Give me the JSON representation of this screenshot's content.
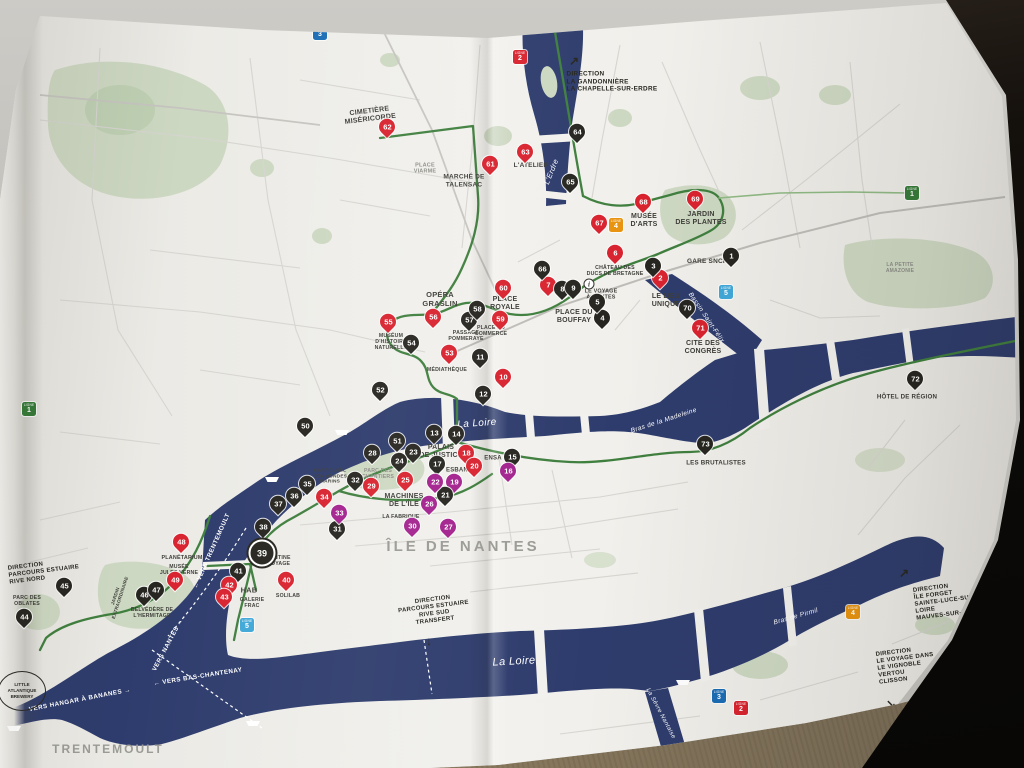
{
  "map": {
    "badge_word": "LIGNE",
    "colors": {
      "river": "#2e3c6d",
      "park": "#cdd8c2",
      "route_green": "#3f7f3e",
      "marker_red": "#d8232f",
      "marker_black": "#26251f",
      "marker_magenta": "#a3228e",
      "line1_green": "#357a38",
      "line2_red": "#d8232f",
      "line3_blue": "#1b6db5",
      "line4_orange": "#e8930f",
      "line5_blue": "#41a8d8",
      "paper": "#f0efeb"
    },
    "markers": [
      {
        "n": 1,
        "c": "k",
        "x": 731,
        "y": 257
      },
      {
        "n": 2,
        "c": "r",
        "x": 660,
        "y": 279
      },
      {
        "n": 3,
        "c": "k",
        "x": 653,
        "y": 267
      },
      {
        "n": 4,
        "c": "k",
        "x": 602,
        "y": 319
      },
      {
        "n": 5,
        "c": "k",
        "x": 597,
        "y": 303
      },
      {
        "n": 6,
        "c": "r",
        "x": 615,
        "y": 254
      },
      {
        "n": 7,
        "c": "r",
        "x": 548,
        "y": 286
      },
      {
        "n": 8,
        "c": "k",
        "x": 562,
        "y": 290
      },
      {
        "n": 9,
        "c": "k",
        "x": 573,
        "y": 289
      },
      {
        "n": 10,
        "c": "r",
        "x": 503,
        "y": 378
      },
      {
        "n": 11,
        "c": "k",
        "x": 480,
        "y": 358
      },
      {
        "n": 12,
        "c": "k",
        "x": 483,
        "y": 395
      },
      {
        "n": 13,
        "c": "k",
        "x": 434,
        "y": 434
      },
      {
        "n": 14,
        "c": "k",
        "x": 456,
        "y": 435
      },
      {
        "n": 15,
        "c": "k",
        "x": 512,
        "y": 458
      },
      {
        "n": 16,
        "c": "m",
        "x": 508,
        "y": 472
      },
      {
        "n": 17,
        "c": "k",
        "x": 437,
        "y": 465
      },
      {
        "n": 18,
        "c": "r",
        "x": 466,
        "y": 454
      },
      {
        "n": 19,
        "c": "m",
        "x": 454,
        "y": 483
      },
      {
        "n": 20,
        "c": "r",
        "x": 474,
        "y": 467
      },
      {
        "n": 21,
        "c": "k",
        "x": 445,
        "y": 496
      },
      {
        "n": 22,
        "c": "m",
        "x": 435,
        "y": 483
      },
      {
        "n": 23,
        "c": "k",
        "x": 413,
        "y": 453
      },
      {
        "n": 24,
        "c": "k",
        "x": 399,
        "y": 462
      },
      {
        "n": 25,
        "c": "r",
        "x": 405,
        "y": 481
      },
      {
        "n": 26,
        "c": "m",
        "x": 429,
        "y": 505
      },
      {
        "n": 27,
        "c": "m",
        "x": 448,
        "y": 528
      },
      {
        "n": 28,
        "c": "k",
        "x": 372,
        "y": 454
      },
      {
        "n": 29,
        "c": "r",
        "x": 371,
        "y": 487
      },
      {
        "n": 30,
        "c": "m",
        "x": 412,
        "y": 527
      },
      {
        "n": 31,
        "c": "k",
        "x": 337,
        "y": 530
      },
      {
        "n": 32,
        "c": "k",
        "x": 355,
        "y": 481
      },
      {
        "n": 33,
        "c": "m",
        "x": 339,
        "y": 514
      },
      {
        "n": 34,
        "c": "r",
        "x": 324,
        "y": 498
      },
      {
        "n": 35,
        "c": "k",
        "x": 307,
        "y": 485
      },
      {
        "n": 36,
        "c": "k",
        "x": 294,
        "y": 497
      },
      {
        "n": 37,
        "c": "k",
        "x": 278,
        "y": 505
      },
      {
        "n": 38,
        "c": "k",
        "x": 263,
        "y": 528
      },
      {
        "n": 39,
        "c": "k",
        "x": 262,
        "y": 553
      },
      {
        "n": 40,
        "c": "r",
        "x": 286,
        "y": 581
      },
      {
        "n": 41,
        "c": "k",
        "x": 238,
        "y": 572
      },
      {
        "n": 42,
        "c": "r",
        "x": 229,
        "y": 586
      },
      {
        "n": 43,
        "c": "r",
        "x": 224,
        "y": 598
      },
      {
        "n": 44,
        "c": "k",
        "x": 24,
        "y": 618
      },
      {
        "n": 45,
        "c": "k",
        "x": 64,
        "y": 587
      },
      {
        "n": 46,
        "c": "k",
        "x": 144,
        "y": 596
      },
      {
        "n": 47,
        "c": "k",
        "x": 156,
        "y": 591
      },
      {
        "n": 48,
        "c": "r",
        "x": 181,
        "y": 543
      },
      {
        "n": 49,
        "c": "r",
        "x": 175,
        "y": 581
      },
      {
        "n": 50,
        "c": "k",
        "x": 305,
        "y": 427
      },
      {
        "n": 51,
        "c": "k",
        "x": 397,
        "y": 442
      },
      {
        "n": 52,
        "c": "k",
        "x": 380,
        "y": 391
      },
      {
        "n": 53,
        "c": "r",
        "x": 449,
        "y": 354
      },
      {
        "n": 54,
        "c": "k",
        "x": 411,
        "y": 344
      },
      {
        "n": 55,
        "c": "r",
        "x": 388,
        "y": 323
      },
      {
        "n": 56,
        "c": "r",
        "x": 433,
        "y": 318
      },
      {
        "n": 57,
        "c": "k",
        "x": 469,
        "y": 321
      },
      {
        "n": 58,
        "c": "k",
        "x": 477,
        "y": 310
      },
      {
        "n": 59,
        "c": "r",
        "x": 500,
        "y": 320
      },
      {
        "n": 60,
        "c": "r",
        "x": 503,
        "y": 289
      },
      {
        "n": 61,
        "c": "r",
        "x": 490,
        "y": 165
      },
      {
        "n": 62,
        "c": "r",
        "x": 387,
        "y": 128
      },
      {
        "n": 63,
        "c": "r",
        "x": 525,
        "y": 153
      },
      {
        "n": 64,
        "c": "k",
        "x": 577,
        "y": 133
      },
      {
        "n": 65,
        "c": "k",
        "x": 570,
        "y": 183
      },
      {
        "n": 66,
        "c": "k",
        "x": 542,
        "y": 270
      },
      {
        "n": 67,
        "c": "r",
        "x": 599,
        "y": 224
      },
      {
        "n": 68,
        "c": "r",
        "x": 643,
        "y": 203
      },
      {
        "n": 69,
        "c": "r",
        "x": 695,
        "y": 200
      },
      {
        "n": 70,
        "c": "k",
        "x": 687,
        "y": 309
      },
      {
        "n": 71,
        "c": "r",
        "x": 700,
        "y": 329
      },
      {
        "n": 72,
        "c": "k",
        "x": 915,
        "y": 380
      },
      {
        "n": 73,
        "c": "k",
        "x": 705,
        "y": 445
      }
    ],
    "labels": [
      {
        "t": "CIMETIÈRE\nMISÉRICORDE",
        "x": 370,
        "y": 116,
        "fs": 7,
        "r": -7
      },
      {
        "t": "PLACE\nVIARME",
        "x": 425,
        "y": 169,
        "fs": 5.5,
        "cl": "sub"
      },
      {
        "t": "MARCHÉ DE\nTALENSAC",
        "x": 464,
        "y": 181,
        "fs": 6.5
      },
      {
        "t": "L'ATELIER",
        "x": 531,
        "y": 166,
        "fs": 6.5
      },
      {
        "t": "MUSÉE\nD'ARTS",
        "x": 644,
        "y": 221,
        "fs": 7
      },
      {
        "t": "JARDIN\nDES PLANTES",
        "x": 701,
        "y": 219,
        "fs": 7
      },
      {
        "t": "GARE SNCF",
        "x": 707,
        "y": 262,
        "fs": 6.5
      },
      {
        "t": "LA PETITE\nAMAZONIE",
        "x": 900,
        "y": 269,
        "fs": 5,
        "cl": "sub"
      },
      {
        "t": "CHÂTEAU DES\nDUCS DE BRETAGNE",
        "x": 615,
        "y": 271,
        "fs": 5.2
      },
      {
        "t": "LE LIEU\nUNIQUE",
        "x": 666,
        "y": 301,
        "fs": 7
      },
      {
        "t": "CITÉ DES\nCONGRÈS",
        "x": 703,
        "y": 348,
        "fs": 7
      },
      {
        "t": "PLACE DU\nBOUFFAY",
        "x": 574,
        "y": 317,
        "fs": 7
      },
      {
        "t": "PLACE\nROYALE",
        "x": 505,
        "y": 304,
        "fs": 7
      },
      {
        "t": "PLACE DU\nCOMMERCE",
        "x": 491,
        "y": 331,
        "fs": 5.2
      },
      {
        "t": "PASSAGE\nPOMMERAYE",
        "x": 466,
        "y": 336,
        "fs": 5.2
      },
      {
        "t": "OPÉRA\nGRASLIN",
        "x": 440,
        "y": 300,
        "fs": 7.5
      },
      {
        "t": "MUSÉUM\nD'HISTOIRE\nNATURELLE",
        "x": 391,
        "y": 342,
        "fs": 5.2
      },
      {
        "t": "MÉDIATHÈQUE",
        "x": 447,
        "y": 370,
        "fs": 5.2
      },
      {
        "t": "PALAIS\nDE JUSTICE",
        "x": 441,
        "y": 452,
        "fs": 7
      },
      {
        "t": "ENSA",
        "x": 493,
        "y": 459,
        "fs": 6
      },
      {
        "t": "ESBAN",
        "x": 457,
        "y": 471,
        "fs": 6
      },
      {
        "t": "PARC DES\nCHANTIERS",
        "x": 378,
        "y": 474,
        "fs": 5.2,
        "cl": "sub"
      },
      {
        "t": "CARROUSEL\nDES MONDES\nMARINS",
        "x": 330,
        "y": 477,
        "fs": 4.8
      },
      {
        "t": "MACHINES\nDE L'ÎLE",
        "x": 404,
        "y": 501,
        "fs": 7
      },
      {
        "t": "LA FABRIQUE",
        "x": 401,
        "y": 517,
        "fs": 5.2
      },
      {
        "t": "LES BRUTALISTES",
        "x": 716,
        "y": 463,
        "fs": 6.2
      },
      {
        "t": "HÔTEL DE RÉGION",
        "x": 907,
        "y": 397,
        "fs": 6.2
      },
      {
        "t": "PLANÉTARIUM",
        "x": 182,
        "y": 558,
        "fs": 5.4
      },
      {
        "t": "MUSÉE\nJULES VERNE",
        "x": 179,
        "y": 570,
        "fs": 5.2
      },
      {
        "t": "BELVÉDÈRE DE\nL'HERMITAGE",
        "x": 152,
        "y": 613,
        "fs": 5.2
      },
      {
        "t": "PARC DES\nOBLATES",
        "x": 27,
        "y": 601,
        "fs": 5.2
      },
      {
        "t": "JARDIN\nEXTRAORDINAIRE",
        "x": 118,
        "y": 597,
        "fs": 4.6,
        "r": -72
      },
      {
        "t": "HAB",
        "x": 249,
        "y": 591,
        "fs": 7.5
      },
      {
        "t": "GALERIE\nFRAC",
        "x": 252,
        "y": 603,
        "fs": 5.2
      },
      {
        "t": "SOLILAB",
        "x": 288,
        "y": 596,
        "fs": 5.2
      },
      {
        "t": "LA CANTINE\nDU VOYAGE",
        "x": 274,
        "y": 561,
        "fs": 5.2
      },
      {
        "t": "LE VOYAGE\nÀ NANTES",
        "x": 601,
        "y": 295,
        "fs": 5.4
      },
      {
        "t": "ÎLE DE NANTES",
        "x": 463,
        "y": 547,
        "fs": 15,
        "ls": 3,
        "cl": "area"
      },
      {
        "t": "TRENTEMOULT",
        "x": 108,
        "y": 749,
        "fs": 12,
        "ls": 2,
        "cl": "area"
      },
      {
        "t": "La Loire",
        "x": 477,
        "y": 424,
        "fs": 10,
        "r": -4,
        "cl": "river"
      },
      {
        "t": "La Loire",
        "x": 514,
        "y": 662,
        "fs": 11,
        "r": -3,
        "cl": "river"
      },
      {
        "t": "L'Erdre",
        "x": 552,
        "y": 172,
        "fs": 7.5,
        "r": -68,
        "cl": "river"
      },
      {
        "t": "Bassin Saint-Félix",
        "x": 706,
        "y": 318,
        "fs": 6.5,
        "r": 56,
        "cl": "river"
      },
      {
        "t": "Bras de la Madeleine",
        "x": 664,
        "y": 421,
        "fs": 6.5,
        "r": -18,
        "cl": "river"
      },
      {
        "t": "Bras de Pirmil",
        "x": 796,
        "y": 617,
        "fs": 6.5,
        "r": -16,
        "cl": "river"
      },
      {
        "t": "La Sèvre Nantaise",
        "x": 660,
        "y": 714,
        "fs": 6,
        "r": 62,
        "cl": "river"
      },
      {
        "t": "← VERS TRENTEMOULT",
        "x": 212,
        "y": 551,
        "fs": 6.2,
        "r": -66,
        "cl": "nav"
      },
      {
        "t": "VERS NANTES →",
        "x": 168,
        "y": 645,
        "fs": 6.2,
        "r": -62,
        "cl": "nav"
      },
      {
        "t": "← VERS BAS-CHANTENAY",
        "x": 198,
        "y": 677,
        "fs": 6.2,
        "r": -9,
        "cl": "nav"
      },
      {
        "t": "VERS HANGAR À BANANES →",
        "x": 80,
        "y": 700,
        "fs": 6.2,
        "r": -11,
        "cl": "nav"
      },
      {
        "t": "DIRECTION\nLA GANDONNIÈRE\nLA CHAPELLE-SUR-ERDRE",
        "x": 612,
        "y": 82,
        "fs": 6.4,
        "ta": "left",
        "cl": "dir"
      },
      {
        "t": "DIRECTION\nPARCOURS ESTUAIRE\nRIVE NORD",
        "x": 44,
        "y": 572,
        "fs": 6,
        "ta": "left",
        "r": -7,
        "cl": "dir"
      },
      {
        "t": "DIRECTION\nPARCOURS ESTUAIRE\nRIVE SUD\nTRANSFERT",
        "x": 434,
        "y": 611,
        "fs": 6,
        "r": -7,
        "cl": "dir"
      },
      {
        "t": "DIRECTION\nÎLE FORGET\nSAINTE-LUCE-SUR-LOIRE\nMAUVES-SUR-LOIRE",
        "x": 951,
        "y": 601,
        "fs": 6,
        "ta": "left",
        "r": -7,
        "cl": "dir"
      },
      {
        "t": "DIRECTION\nLE VOYAGE DANS\nLE VIGNOBLE\nVERTOU\nCLISSON",
        "x": 906,
        "y": 666,
        "fs": 6,
        "ta": "left",
        "r": -7,
        "cl": "dir"
      }
    ],
    "arrows": [
      {
        "g": "↗",
        "x": 574,
        "y": 61
      },
      {
        "g": "↓",
        "x": 429,
        "y": 641
      },
      {
        "g": "↗",
        "x": 904,
        "y": 573
      },
      {
        "g": "↘",
        "x": 891,
        "y": 704
      }
    ],
    "badges": [
      {
        "n": "3",
        "c": "#1b6db5",
        "x": 320,
        "y": 33
      },
      {
        "n": "2",
        "c": "#d8232f",
        "x": 520,
        "y": 57
      },
      {
        "n": "1",
        "c": "#357a38",
        "x": 912,
        "y": 193
      },
      {
        "n": "1",
        "c": "#357a38",
        "x": 29,
        "y": 409
      },
      {
        "n": "4",
        "c": "#e8930f",
        "x": 616,
        "y": 225
      },
      {
        "n": "5",
        "c": "#41a8d8",
        "x": 726,
        "y": 292
      },
      {
        "n": "5",
        "c": "#41a8d8",
        "x": 247,
        "y": 625
      },
      {
        "n": "4",
        "c": "#e8930f",
        "x": 853,
        "y": 612
      },
      {
        "n": "3",
        "c": "#1b6db5",
        "x": 719,
        "y": 696
      },
      {
        "n": "2",
        "c": "#d8232f",
        "x": 741,
        "y": 708
      }
    ],
    "info_icon": {
      "glyph": "i",
      "x": 589,
      "y": 284
    },
    "brewery": {
      "t": "LITTLE\nATLANTIQUE\nBREWERY",
      "x": 22,
      "y": 691
    },
    "ferries": [
      {
        "x": 342,
        "y": 431
      },
      {
        "x": 272,
        "y": 478
      },
      {
        "x": 253,
        "y": 722
      },
      {
        "x": 683,
        "y": 681
      },
      {
        "x": 14,
        "y": 727
      }
    ]
  }
}
